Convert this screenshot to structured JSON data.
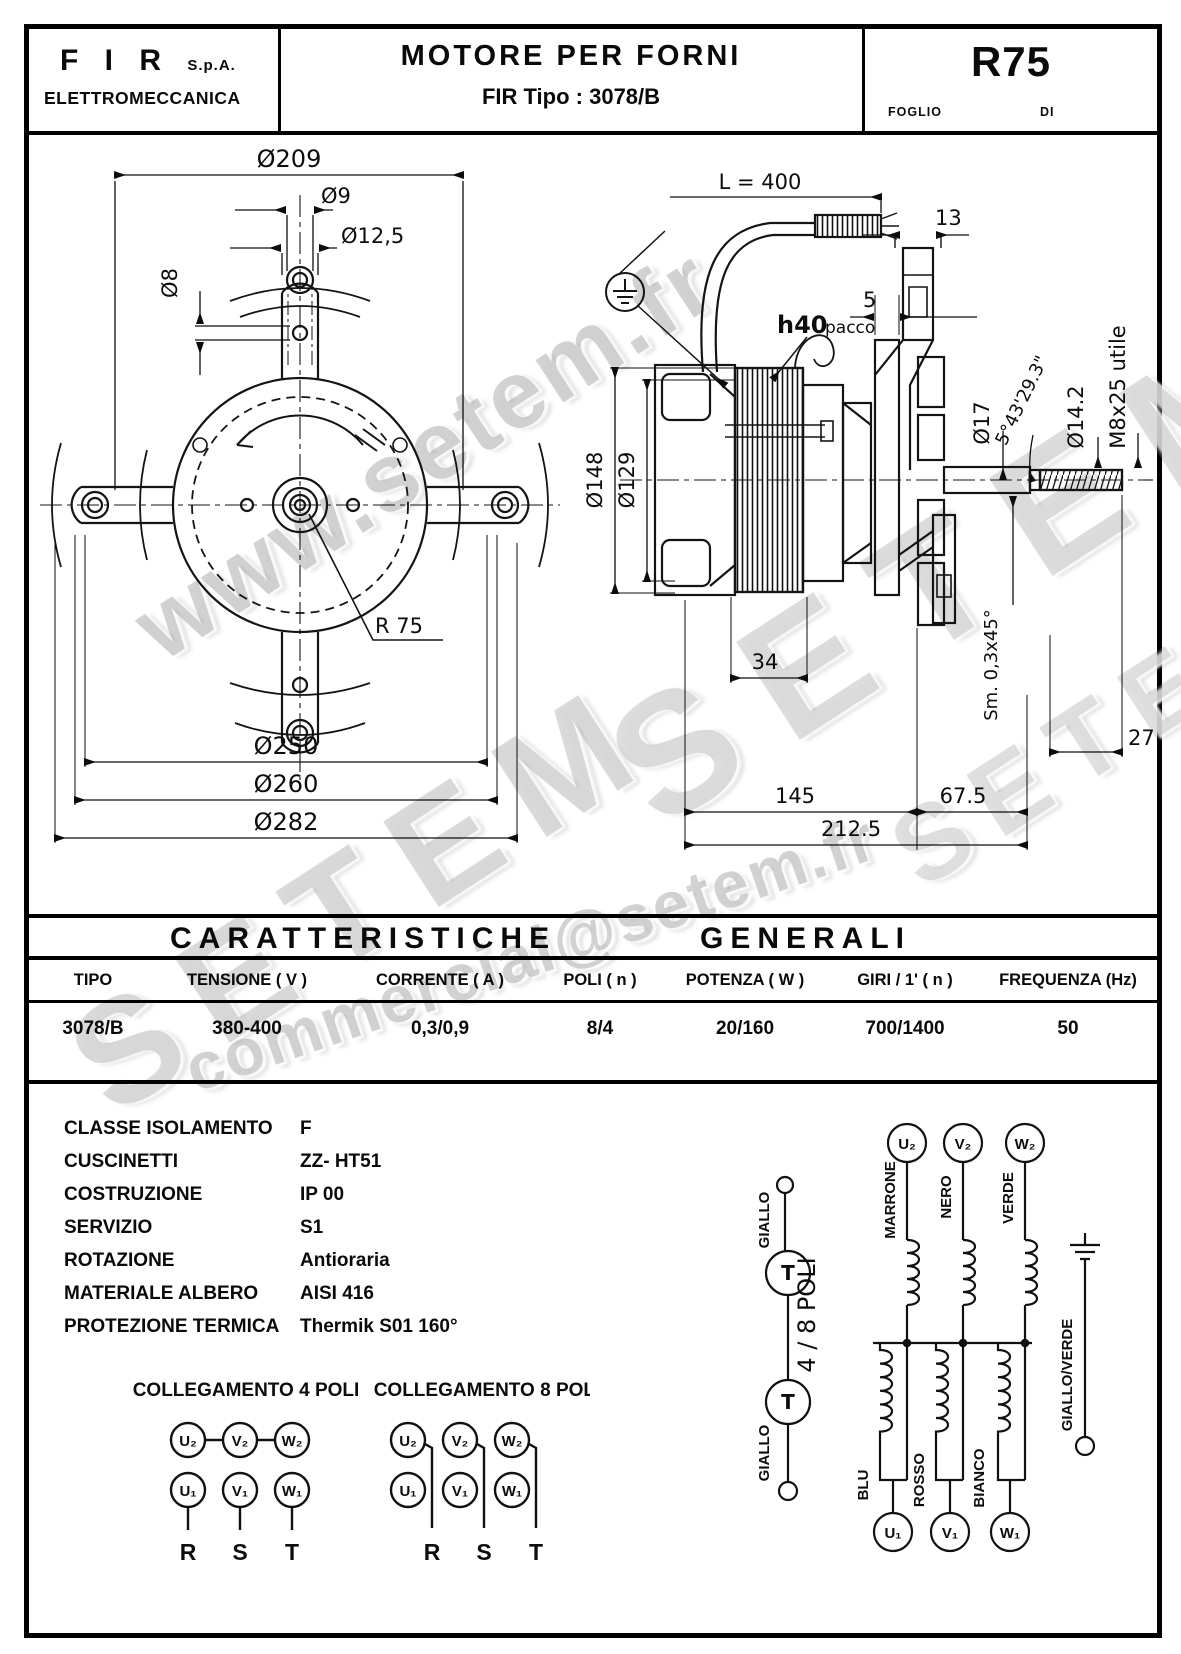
{
  "header": {
    "company_name": "F I R",
    "company_suffix": "S.p.A.",
    "company_sub": "ELETTROMECCANICA",
    "title": "MOTORE  PER  FORNI",
    "subtitle_prefix": "FIR Tipo : ",
    "subtitle_model": "3078/B",
    "doc_code": "R75",
    "foglio_label": "FOGLIO",
    "di_label": "DI"
  },
  "watermarks": [
    "www.setem.fr",
    "SETEM",
    "SETEM",
    "commercial@setem.fr",
    "SETEM"
  ],
  "front_view": {
    "d209": "Ø209",
    "d9": "Ø9",
    "d12_5": "Ø12,5",
    "d8": "Ø8",
    "r75": "R 75",
    "d250": "Ø250",
    "d260": "Ø260",
    "d282": "Ø282"
  },
  "side_view": {
    "l400": "L  =  400",
    "n13": "13",
    "n5": "5",
    "h40": "h40",
    "pacco": "pacco",
    "d148": "Ø148",
    "d129": "Ø129",
    "d17": "Ø17",
    "angle": "5°43'29.3\"",
    "d14_2": "Ø14.2",
    "m8": "M8x25 utile",
    "n34": "34",
    "smusso": "Sm. 0,3x45°",
    "n27_5": "27.5",
    "n145": "145",
    "n67_5": "67.5",
    "n212_5": "212.5"
  },
  "table": {
    "title_left": "CARATTERISTICHE",
    "title_right": "GENERALI",
    "columns": [
      "TIPO",
      "TENSIONE ( V )",
      "CORRENTE ( A )",
      "POLI ( n )",
      "POTENZA ( W )",
      "GIRI / 1' ( n )",
      "FREQUENZA (Hz)"
    ],
    "row": [
      "3078/B",
      "380-400",
      "0,3/0,9",
      "8/4",
      "20/160",
      "700/1400",
      "50"
    ]
  },
  "specs": [
    {
      "label": "CLASSE ISOLAMENTO",
      "value": "F"
    },
    {
      "label": "CUSCINETTI",
      "value": "ZZ- HT51"
    },
    {
      "label": "COSTRUZIONE",
      "value": "IP 00"
    },
    {
      "label": "SERVIZIO",
      "value": "S1"
    },
    {
      "label": "ROTAZIONE",
      "value": "Antioraria"
    },
    {
      "label": "MATERIALE ALBERO",
      "value": "AISI 416"
    },
    {
      "label": "PROTEZIONE TERMICA",
      "value": "Thermik S01 160°"
    }
  ],
  "connections": {
    "title_4": "COLLEGAMENTO 4 POLI",
    "title_8": "COLLEGAMENTO 8 POLI",
    "u2": "U₂",
    "v2": "V₂",
    "w2": "W₂",
    "u1": "U₁",
    "v1": "V₁",
    "w1": "W₁",
    "r": "R",
    "s": "S",
    "t": "T"
  },
  "schematic": {
    "giallo_top": "GIALLO",
    "giallo_bottom": "GIALLO",
    "t_label": "T",
    "pole_label": "4 / 8 POLI",
    "marrone": "MARRONE",
    "nero": "NERO",
    "verde": "VERDE",
    "blu": "BLU",
    "rosso": "ROSSO",
    "bianco": "BIANCO",
    "giallo_verde": "GIALLO/VERDE",
    "u2": "U₂",
    "v2": "V₂",
    "w2": "W₂",
    "u1": "U₁",
    "v1": "V₁",
    "w1": "W₁"
  }
}
